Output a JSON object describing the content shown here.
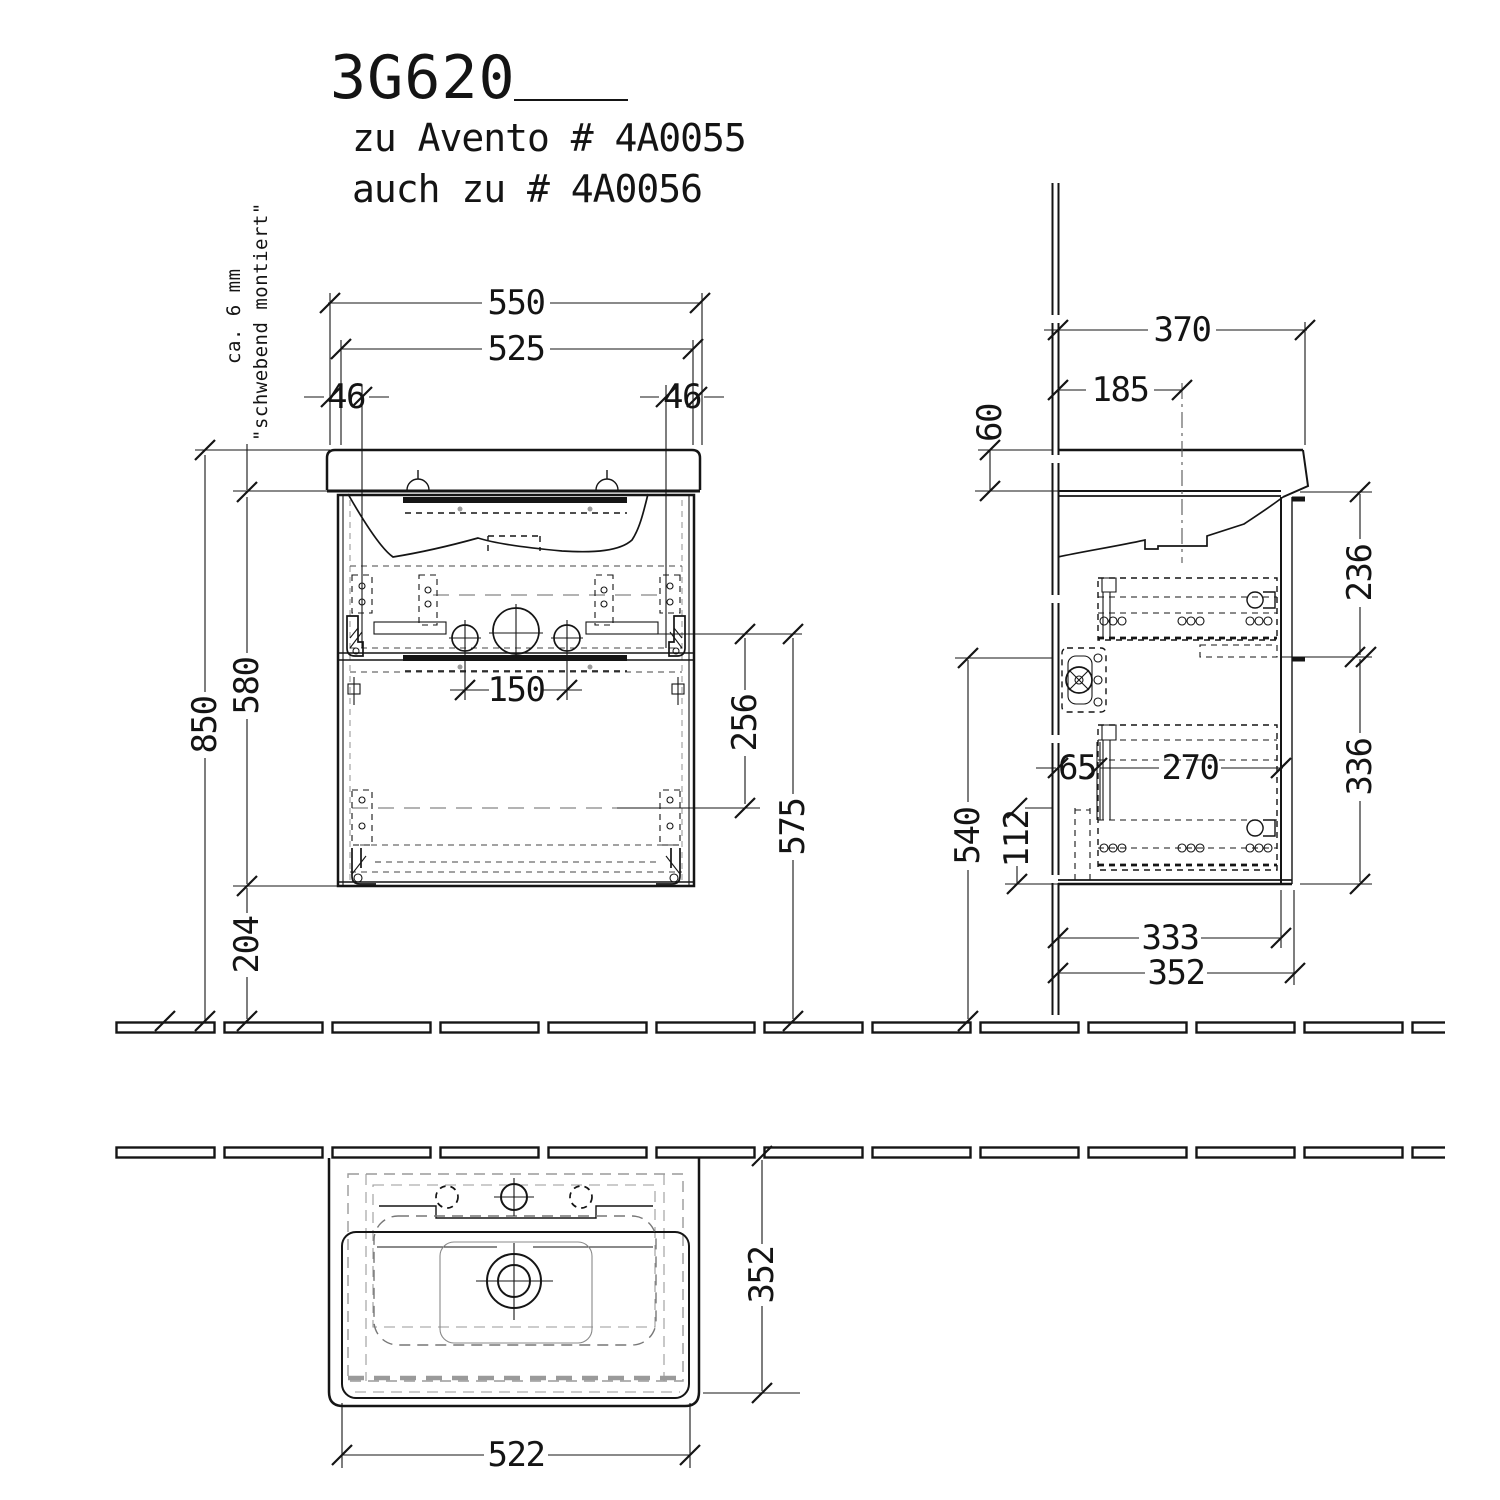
{
  "drawing": {
    "title_code": "3G620",
    "subtitle_line1": "zu Avento # 4A0055",
    "subtitle_line2": "auch zu # 4A0056",
    "note_line1": "ca. 6 mm",
    "note_line2": "\"schwebend montiert\""
  },
  "front_view": {
    "width_outer": "550",
    "width_fixing": "525",
    "fixing_offset_left": "46",
    "fixing_offset_right": "46",
    "height_rim": "850",
    "height_cabinet": "580",
    "height_below_cabinet": "204",
    "tap_hole_distance": "150",
    "cutout_height": "256",
    "siphon_clearance": "575"
  },
  "side_view": {
    "depth_basin": "370",
    "depth_to_center": "185",
    "basin_edge_height": "60",
    "upper_front_height": "236",
    "lower_front_height": "336",
    "front_clearance_height": "540",
    "wall_offset": "65",
    "inner_depth": "270",
    "bottom_edge_height": "112",
    "cabinet_depth": "333",
    "total_depth": "352"
  },
  "plan_view": {
    "cabinet_width": "522",
    "cabinet_depth": "352"
  },
  "colors": {
    "ink": "#151515",
    "hidden_gray": "#9a9a9a"
  }
}
